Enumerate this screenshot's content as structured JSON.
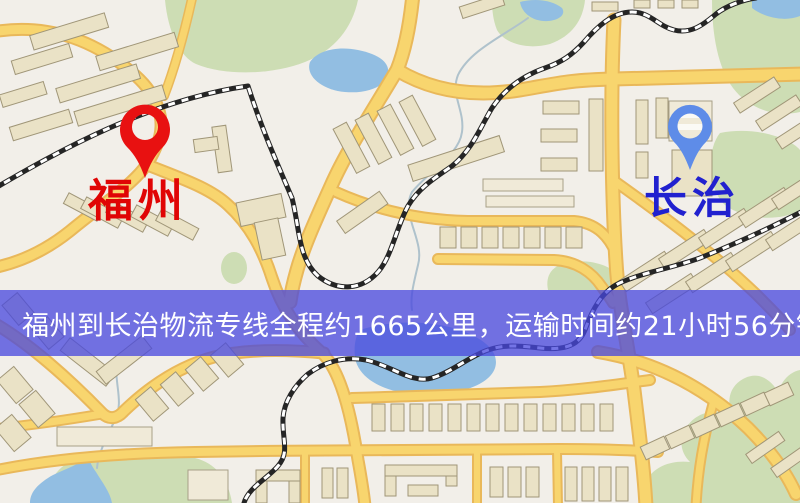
{
  "banner": {
    "text": "福州到长治物流专线全程约1665公里，运输时间约21小时56分钟.",
    "background_color": "#4848DE",
    "text_color": "#FFFFFF"
  },
  "route": {
    "origin_city": "福州",
    "destination_city": "长治",
    "service_type": "物流专线",
    "distance_text": "约1665公里",
    "duration_text": "约21小时56分钟"
  },
  "markers": {
    "origin": {
      "label": "福州",
      "pin_color": "#E81111",
      "label_color": "#E00505"
    },
    "destination": {
      "label": "长治",
      "pin_color": "#5E8CE8",
      "label_color": "#2121CF"
    }
  },
  "map": {
    "colors": {
      "background": "#F2EFE9",
      "road_fill": "#F8D56E",
      "road_casing": "#E9B85A",
      "building": "#EAE2C6",
      "park_green": "#CDDDB4",
      "water_blue": "#92BEE2",
      "railway_dark": "#252525"
    }
  }
}
